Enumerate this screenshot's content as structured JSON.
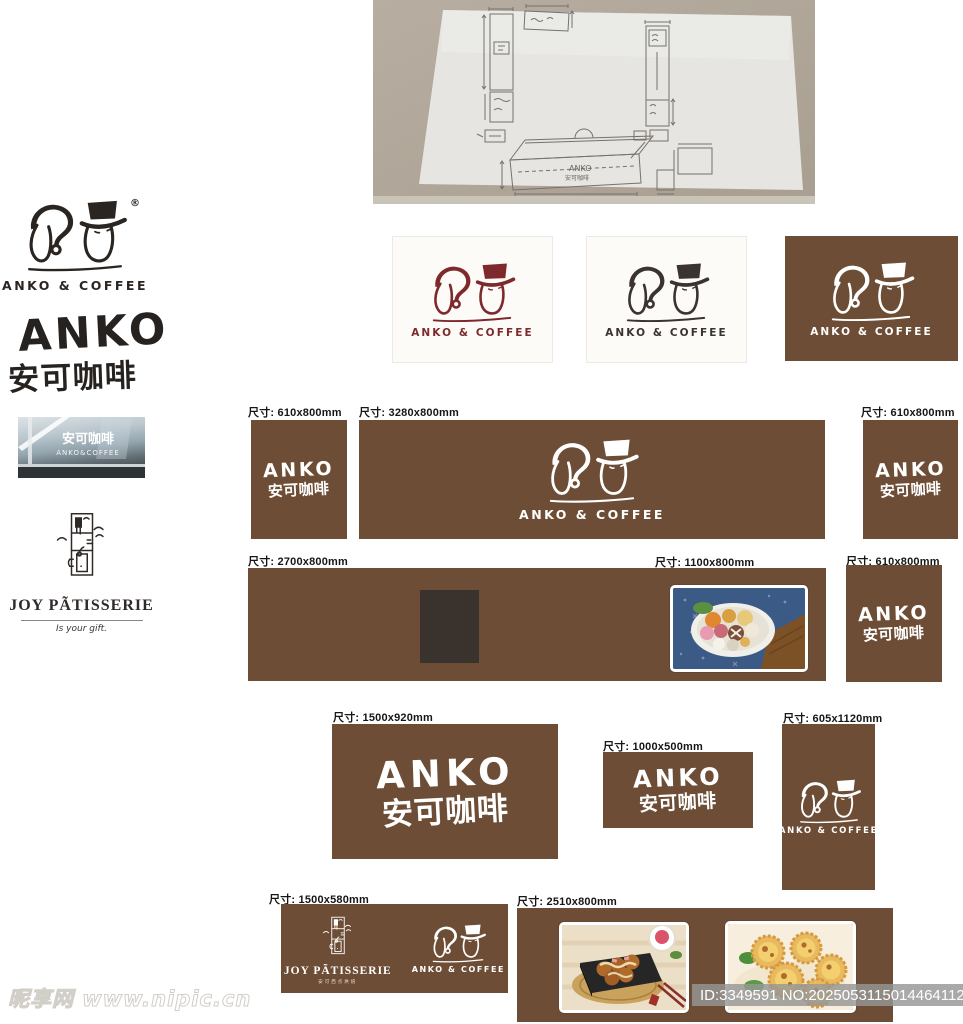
{
  "meta": {
    "watermark": "昵享网 www.nipic.cn",
    "id_text": "ID:3349591 NO:20250531150144641121"
  },
  "brand": {
    "logo_text": "ANKO & COFFEE",
    "registered": "®",
    "wordmark_en": "ANKO",
    "wordmark_cn": "安可咖啡"
  },
  "colors": {
    "sign_brown": "#6d4d35",
    "logo_maroon": "#7e2a2d",
    "logo_dark": "#3a3330",
    "logo_white": "#ffffff",
    "door_dark": "#3a322d"
  },
  "storefront": {
    "sign_cn": "安可咖啡",
    "sign_en": "ANKO&COFFEE"
  },
  "joy": {
    "name": "JOY PÃTISSERIE",
    "tagline": "Is your gift.",
    "subtext": "安可西点烘焙"
  },
  "sketch": {
    "box_label_en": "ANKO",
    "box_label_cn": "安可咖啡"
  },
  "labels": {
    "r1a": "尺寸: 610x800mm",
    "r1b": "尺寸: 3280x800mm",
    "r1c": "尺寸: 610x800mm",
    "r2a": "尺寸: 2700x800mm",
    "r2a_photo": "尺寸: 1100x800mm",
    "r2b": "尺寸: 610x800mm",
    "r3a": "尺寸: 1500x920mm",
    "r3b": "尺寸: 1000x500mm",
    "r3c": "尺寸: 605x1120mm",
    "r4a": "尺寸: 1500x580mm",
    "r4b": "尺寸: 2510x800mm"
  }
}
